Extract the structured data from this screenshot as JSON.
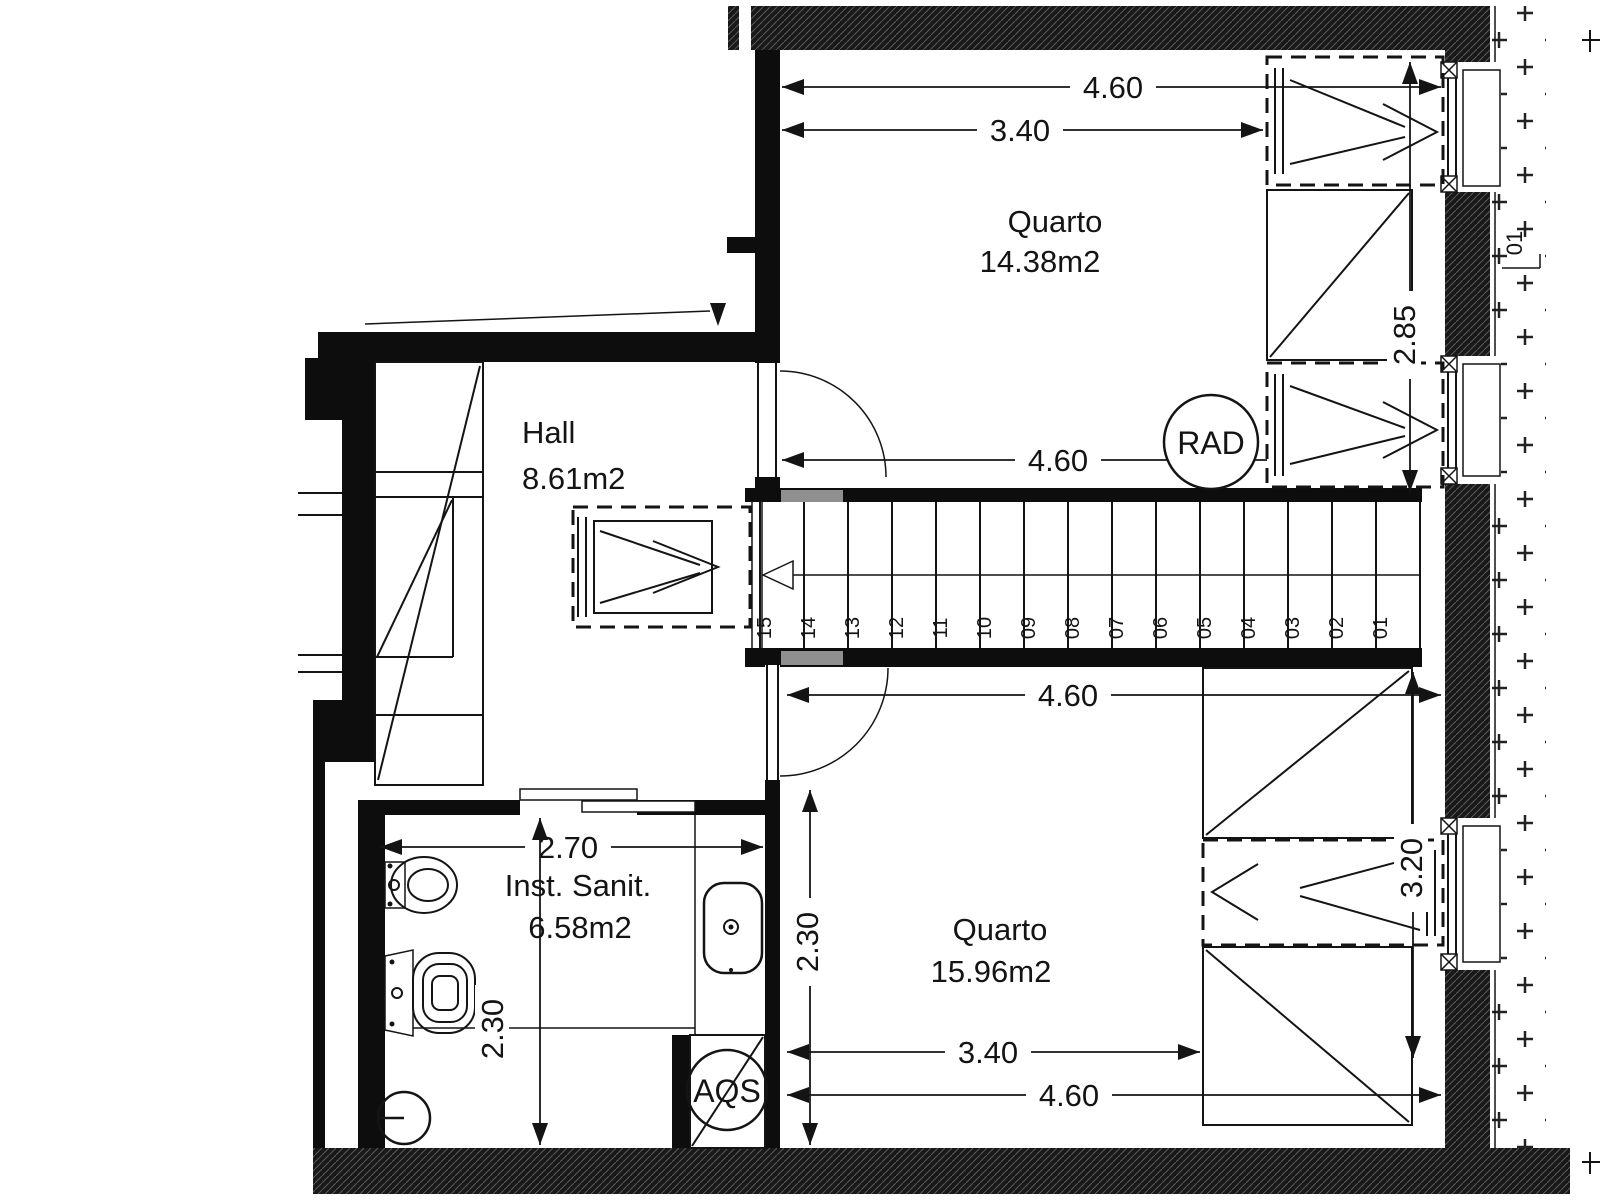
{
  "rooms": {
    "quarto_top": {
      "name": "Quarto",
      "area": "14.38m2"
    },
    "hall": {
      "name": "Hall",
      "area": "8.61m2"
    },
    "inst_sanit": {
      "name": "Inst. Sanit.",
      "area": "6.58m2"
    },
    "quarto_bottom": {
      "name": "Quarto",
      "area": "15.96m2"
    }
  },
  "markers": {
    "radiator": "RAD",
    "water_heater": "AQS",
    "exterior_level": "01"
  },
  "dims": {
    "top_total_width": "4.60",
    "top_inner_width": "3.40",
    "top_mid_width": "4.60",
    "top_wardrobe_height": "2.85",
    "bottom_total_width": "4.60",
    "bottom_partial_height": "2.30",
    "bottom_inner_width": "3.40",
    "bottom_lower_width": "4.60",
    "bottom_wardrobe_height": "3.20",
    "bath_width": "2.70",
    "bath_height": "2.30"
  },
  "stairs": {
    "steps": [
      "15",
      "14",
      "13",
      "12",
      "11",
      "10",
      "09",
      "08",
      "07",
      "06",
      "05",
      "04",
      "03",
      "02",
      "01"
    ]
  },
  "colors": {
    "line": "#141414",
    "wall_fill": "#0d0d0d",
    "accent_gray": "#8f8f8f",
    "background": "#ffffff"
  }
}
